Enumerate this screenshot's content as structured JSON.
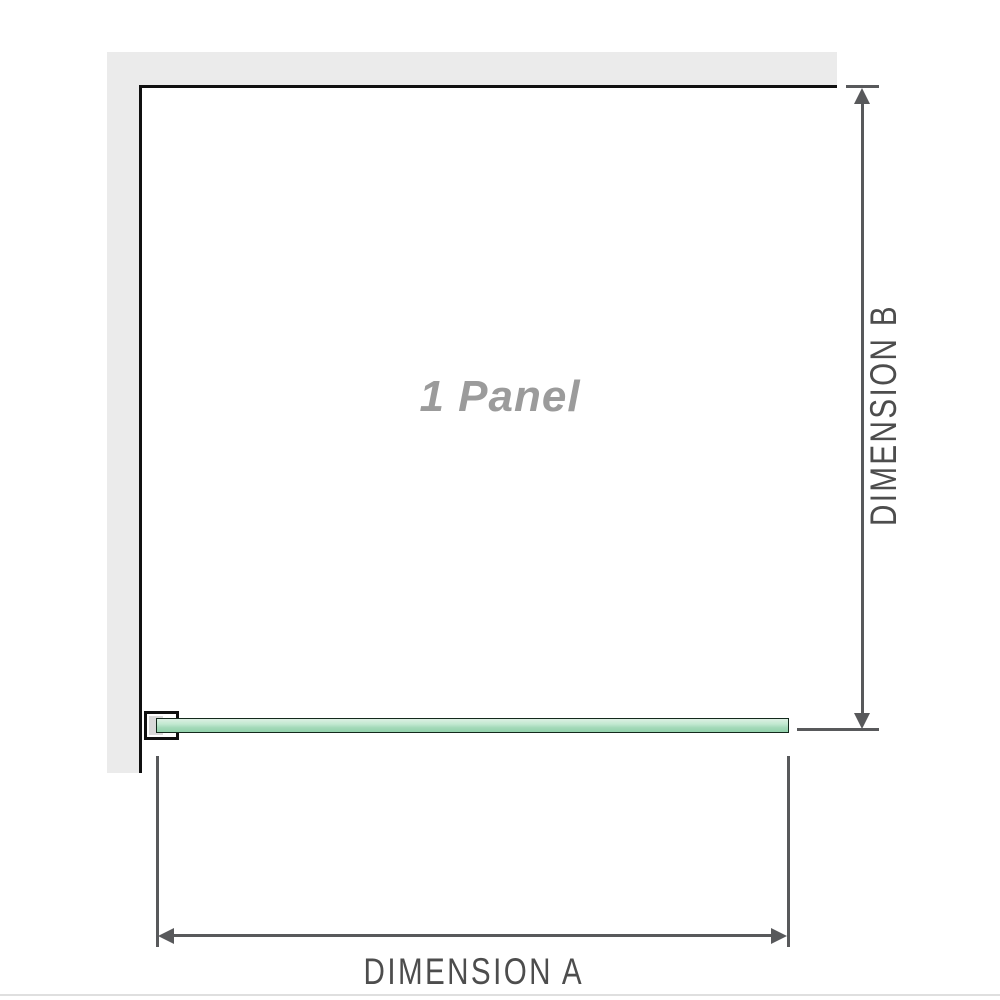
{
  "diagram": {
    "panel_label": "1 Panel",
    "dimension_a_label": "DIMENSION A",
    "dimension_b_label": "DIMENSION B"
  },
  "colors": {
    "wall_fill": "#ebebeb",
    "wall_edge": "#101010",
    "bracket_fill": "#ffffff",
    "bracket_inner": "#d9d9d9",
    "glass_border": "#13291c",
    "glass_green_light": "#ddf0e3",
    "glass_green_mid": "#a2d9b8",
    "glass_green_deep": "#93d2ac",
    "dimension_line": "#58595b",
    "label_gray": "#4d4d4d",
    "panel_label_gray": "#9b9b9b",
    "divider": "#dfdfdf"
  }
}
